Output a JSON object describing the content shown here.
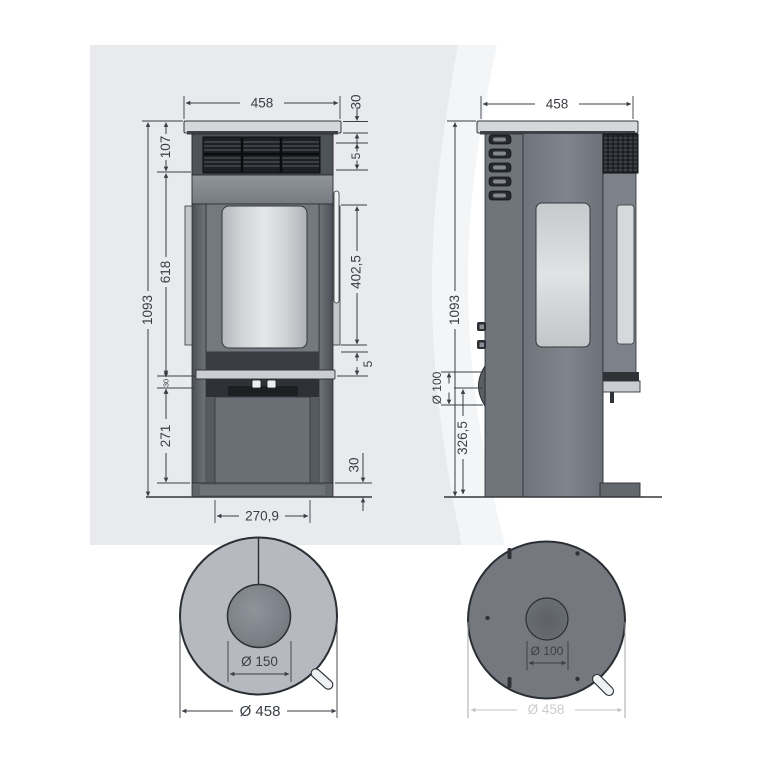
{
  "title": "Round stove technical dimension drawing",
  "colors": {
    "background": "#ffffff",
    "watermark_gray": "#e8eaed",
    "watermark_band": "#f3f5f7",
    "dimension_line": "#3a3f45",
    "body_gray": "#7a7f87",
    "panel_dark": "#2c2f33",
    "glass_light": "#dde0e2",
    "plate_light": "#d5d8db",
    "top_view_fill": "#b6bac0",
    "bottom_view_fill": "#75797f"
  },
  "views": {
    "front": {
      "label": "front-elevation",
      "dims": {
        "width": "458",
        "plate_height": "30",
        "top_section": "107",
        "grille_gap": "5",
        "door_section": "618",
        "glass_height": "402,5",
        "total_height": "1093",
        "shelf_thickness": "30",
        "base_section": "271",
        "door_gap": "5",
        "plinth_height": "30",
        "door_width": "270,9"
      }
    },
    "side": {
      "label": "side-elevation",
      "dims": {
        "width": "458",
        "total_height": "1093",
        "inlet_diameter": "Ø 100",
        "inlet_center_height": "326,5"
      }
    },
    "top": {
      "label": "top-plan",
      "dims": {
        "flue_diameter": "Ø 150",
        "outer_diameter": "Ø 458"
      }
    },
    "bottom": {
      "label": "bottom-plan",
      "dims": {
        "inlet_diameter": "Ø 100",
        "outer_diameter": "Ø 458"
      }
    }
  }
}
